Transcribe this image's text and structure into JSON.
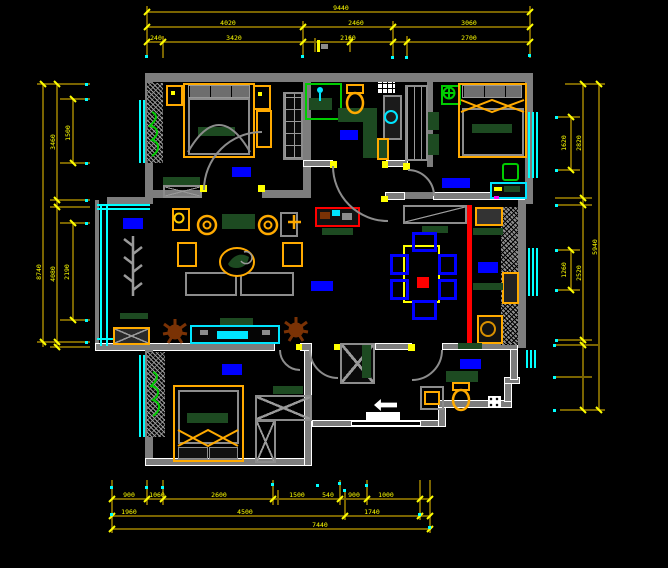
{
  "drawing": {
    "kind": "residential floor plan (CAD)",
    "background": "#000000",
    "palette": {
      "wall": "#7d7d7d",
      "dimension_line": "#7a6400",
      "dimension_text": "#ffff00",
      "window_glass": "#00ffff",
      "room_label_block": "#0000ff",
      "furniture_accent": "#ffaa00",
      "soft_furnishing": "#1d4a21",
      "plant_green": "#00cc00",
      "plant_brown": "#7a3205",
      "slide_door_marker": "#ff0000",
      "grip_dot": "#00ffff"
    }
  },
  "dims": {
    "top": {
      "row1": [
        "9440"
      ],
      "row2": [
        "4020",
        "2460",
        "3060"
      ],
      "row3": [
        "240",
        "3420",
        "2160",
        "2700"
      ]
    },
    "bottom": {
      "row1": [
        "900",
        "1060",
        "2600",
        "1500",
        "540",
        "900",
        "1000"
      ],
      "row2": [
        "1960",
        "4500",
        "1740"
      ],
      "row3": [
        "7440"
      ]
    },
    "left": {
      "outer": [
        "8740"
      ],
      "mid": [
        "3460",
        "4080"
      ],
      "inner": [
        "1500",
        "2190"
      ]
    },
    "right": {
      "outer": [
        "5940"
      ],
      "mid": [
        "2820",
        "2520"
      ],
      "inner": [
        "1620",
        "1260"
      ]
    }
  },
  "rooms": {
    "label_blocks": [
      "bedroom-top-left",
      "bathroom-top",
      "bedroom-top-right",
      "living-bay",
      "hallway",
      "kitchen",
      "bedroom-bottom-left",
      "bathroom-bottom-right"
    ]
  }
}
